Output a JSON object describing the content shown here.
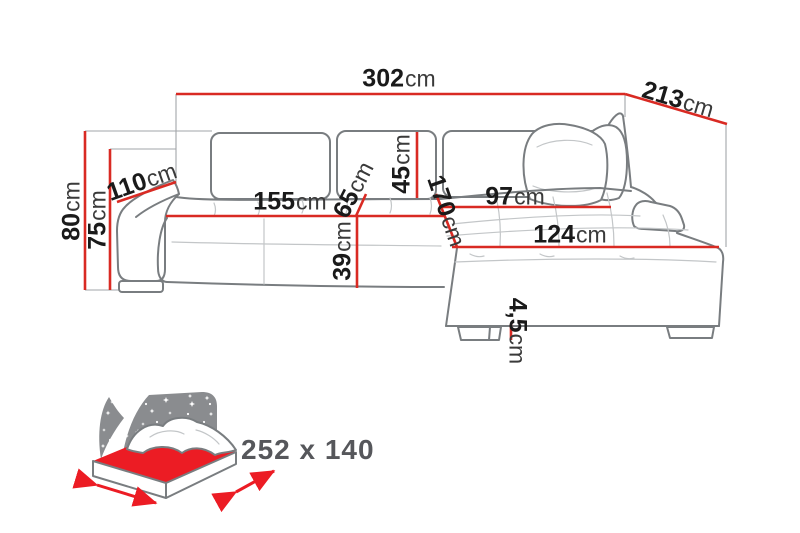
{
  "dimensions": {
    "total_width": {
      "value": "302",
      "unit": "cm"
    },
    "total_depth": {
      "value": "213",
      "unit": "cm"
    },
    "back_height": {
      "value": "80",
      "unit": "cm"
    },
    "arm_height": {
      "value": "75",
      "unit": "cm"
    },
    "arm_depth": {
      "value": "110",
      "unit": "cm"
    },
    "seat_width": {
      "value": "155",
      "unit": "cm"
    },
    "seat_depth": {
      "value": "65",
      "unit": "cm"
    },
    "back_cushion_height": {
      "value": "45",
      "unit": "cm"
    },
    "seat_height": {
      "value": "39",
      "unit": "cm"
    },
    "chaise_length": {
      "value": "170",
      "unit": "cm"
    },
    "chaise_back_width": {
      "value": "97",
      "unit": "cm"
    },
    "chaise_front_width": {
      "value": "124",
      "unit": "cm"
    },
    "leg_height": {
      "value": "4,5",
      "unit": "cm"
    }
  },
  "sleeping_area": {
    "size": "252 x 140"
  },
  "colors": {
    "dimension_red": "#d92a23",
    "icon_red": "#ec1c24",
    "outline_gray": "#797d80",
    "night_sky_gray": "#8a8c8f",
    "sleeping_text": "#56575b"
  }
}
